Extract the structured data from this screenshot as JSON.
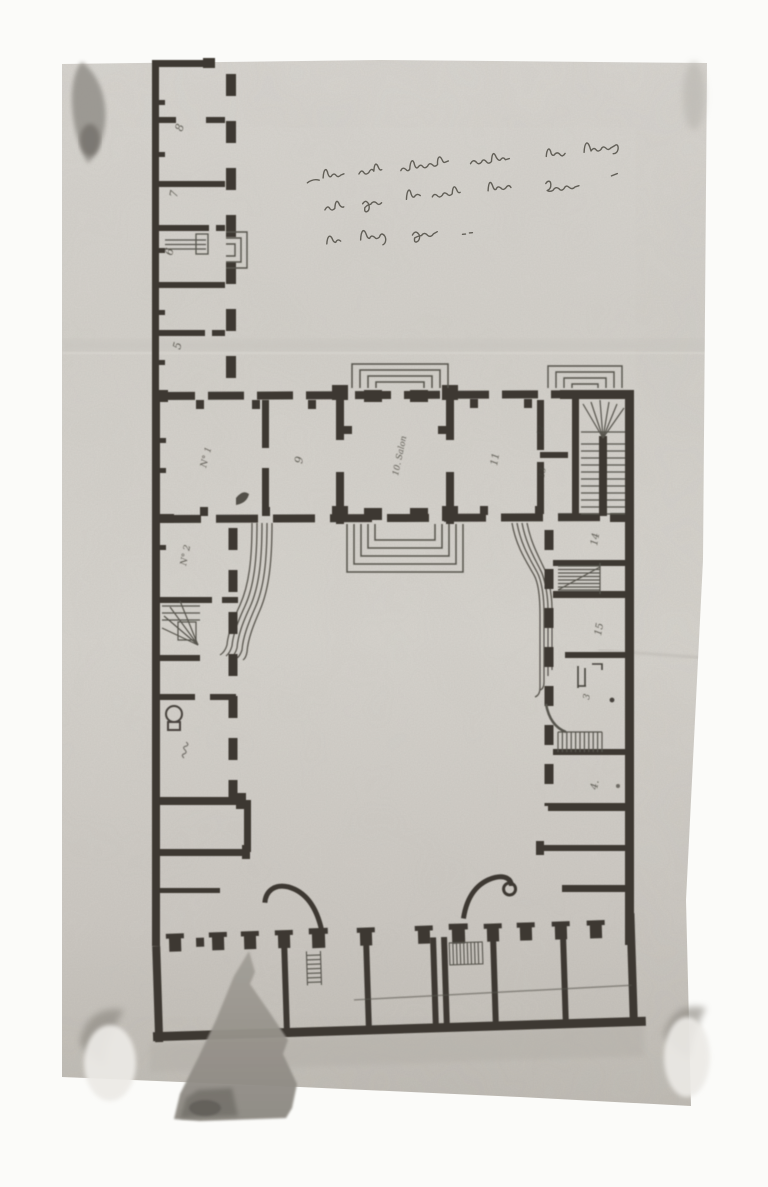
{
  "document": {
    "type": "black-and-white photograph of a hand-drawn architectural ground plan, mounted on a white album page",
    "subject": "U-shaped palace / manor plan around an inner courtyard, with a long detached service wing at upper left and an open colonnaded stable range at the bottom",
    "orientation_note": "room numbers are written sideways (plan meant to be read from the right edge)"
  },
  "annotation": {
    "position": "upper right area of the sheet, three lines of French cursive ink handwriting",
    "legibility": "largely illegible",
    "lines": [
      "Plan de la Maison, apartement avec (?) logement (illegible cursive)",
      "des famelles (?) de la cour. Occupee par (?) (illegible cursive)",
      "le Duc de Serge (?) (illegible cursive)"
    ]
  },
  "plan": {
    "west_wing_upper": {
      "rooms": [
        {
          "label": "8"
        },
        {
          "label": "7"
        },
        {
          "label": "6"
        },
        {
          "label": "5"
        }
      ],
      "features": [
        "dashed pillared wall toward the yard",
        "small outside step porch beside room 6"
      ]
    },
    "north_range": {
      "rooms": [
        {
          "label": "N° 1"
        },
        {
          "label": "9"
        },
        {
          "label": "10. Salon"
        },
        {
          "label": "11"
        },
        {
          "label": "12"
        },
        {
          "label": "13"
        }
      ],
      "features": [
        "central salon projecting with stepped porches on both fronts",
        "grand fan staircase at the east end",
        "stepped porch before the staircase"
      ]
    },
    "west_range": {
      "rooms": [
        {
          "label": "N° 2"
        },
        {
          "label": "(illegible)"
        }
      ],
      "features": [
        "winder staircase",
        "round stove",
        "dashed courtyard wall"
      ]
    },
    "east_range": {
      "rooms": [
        {
          "label": "14"
        },
        {
          "label": "15"
        },
        {
          "label": "3"
        },
        {
          "label": "4."
        }
      ],
      "features": [
        "two hatched staircases",
        "furniture marks in one room"
      ]
    },
    "south_range": {
      "features": [
        "row of square pillars along the courtyard",
        "two curved gate-leaf swings at the carriage opening",
        "partition walls of stable bays",
        "two small hatched stairs"
      ]
    },
    "courtyard_features": [
      "curved multi-line ramp sweeping from the salon front along the west range",
      "shorter curved ramp on the east side"
    ]
  },
  "artifacts": {
    "top_left": "dark ink smudge at the photo edge",
    "top_right": "faint vertical smudge",
    "bottom_left": "light round photo-corner disc with dark shading above",
    "bottom_right": "light round photo-corner disc with dark shading above",
    "bottom_center": "large dark triangular stain / tear running off the lower photo edge",
    "creases": [
      "horizontal fold line across the sheet above the main block",
      "short crease near right edge below the east wing"
    ]
  },
  "colors": {
    "album_page": "#fbfbf9",
    "photo_paper": "#d5d2cc",
    "ink": "#3c3933",
    "handwriting": "#4a473f",
    "stain": "#98948d",
    "shadow": "#b4b0a9"
  }
}
